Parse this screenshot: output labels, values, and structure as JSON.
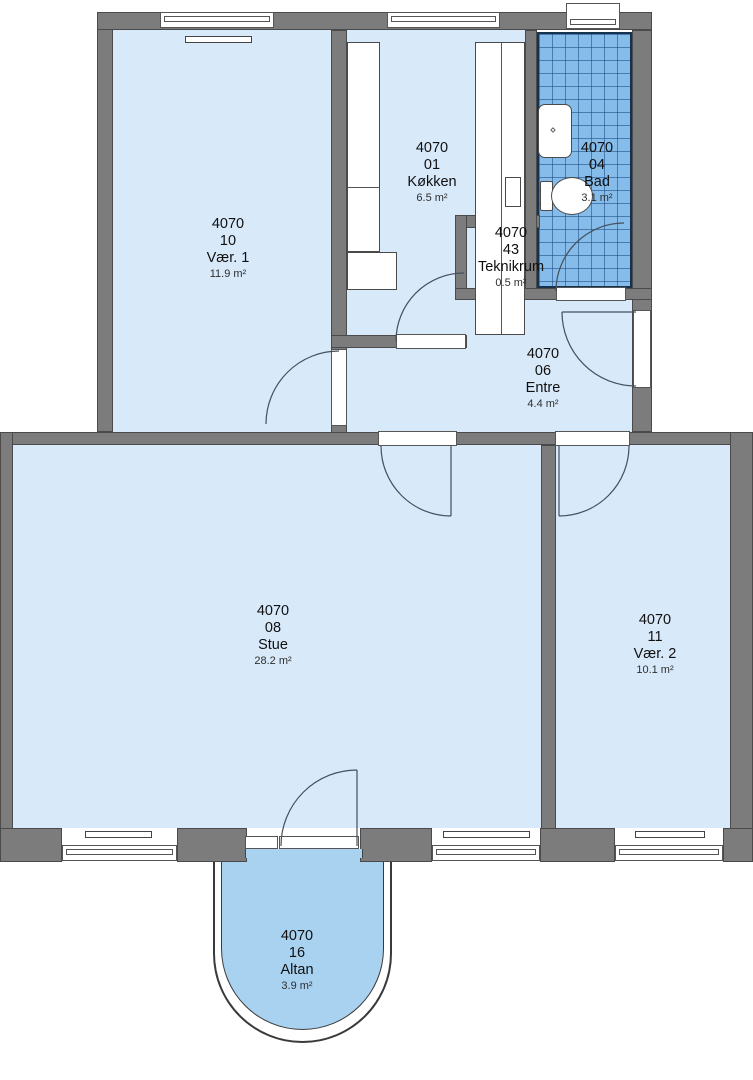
{
  "rooms": [
    {
      "code": "4070",
      "number": "10",
      "name": "Vær. 1",
      "area": "11.9 m²"
    },
    {
      "code": "4070",
      "number": "01",
      "name": "Køkken",
      "area": "6.5 m²"
    },
    {
      "code": "4070",
      "number": "04",
      "name": "Bad",
      "area": "3.1 m²"
    },
    {
      "code": "4070",
      "number": "43",
      "name": "Teknikrum",
      "area": "0.5 m²"
    },
    {
      "code": "4070",
      "number": "06",
      "name": "Entre",
      "area": "4.4 m²"
    },
    {
      "code": "4070",
      "number": "08",
      "name": "Stue",
      "area": "28.2 m²"
    },
    {
      "code": "4070",
      "number": "11",
      "name": "Vær. 2",
      "area": "10.1 m²"
    },
    {
      "code": "4070",
      "number": "16",
      "name": "Altan",
      "area": "3.9 m²"
    }
  ],
  "fixtures": {
    "bathroom": [
      "shower-tray",
      "toilet"
    ],
    "kitchen": [
      "counter-left",
      "refrigerator",
      "counter-right",
      "cooktop"
    ],
    "heating": [
      "radiator"
    ]
  },
  "colors": {
    "wall": "#7c7c7c",
    "room_floor": "#d8e9fa",
    "balcony_floor": "#a9d2f0",
    "bath_tile": "#85bce9",
    "bath_tile_line": "#19468266",
    "outline": "#4a4a4a"
  }
}
